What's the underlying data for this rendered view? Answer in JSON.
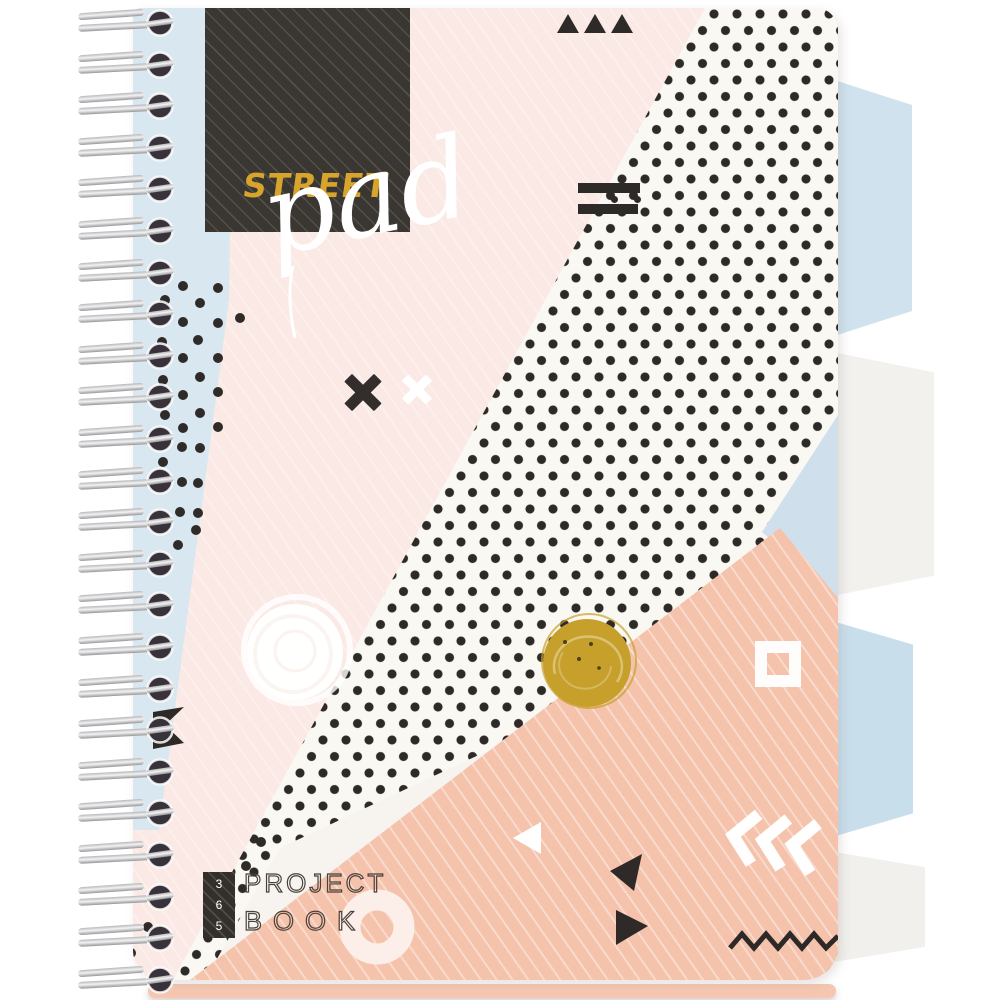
{
  "product": {
    "brand": "STREET",
    "series": "pad",
    "badge_digits": [
      "3",
      "6",
      "5"
    ],
    "title_line1": "PROJECT",
    "title_line2": "BOOK"
  },
  "colors": {
    "blush": "#fbe9e5",
    "peach": "#f5c3ac",
    "blue_stripe": "#d9e7f1",
    "tab_blue": "#cfe2ee",
    "tab_white": "#f2f1ee",
    "polka_background": "#faf8f3",
    "polka_dot": "#2d2a28",
    "gold_scribble": "#c6a02b",
    "logo_gold": "#d7a42c",
    "logo_box": "#3a3631",
    "ink": "#2e2a27",
    "page_stack": "#f5c7b2"
  }
}
